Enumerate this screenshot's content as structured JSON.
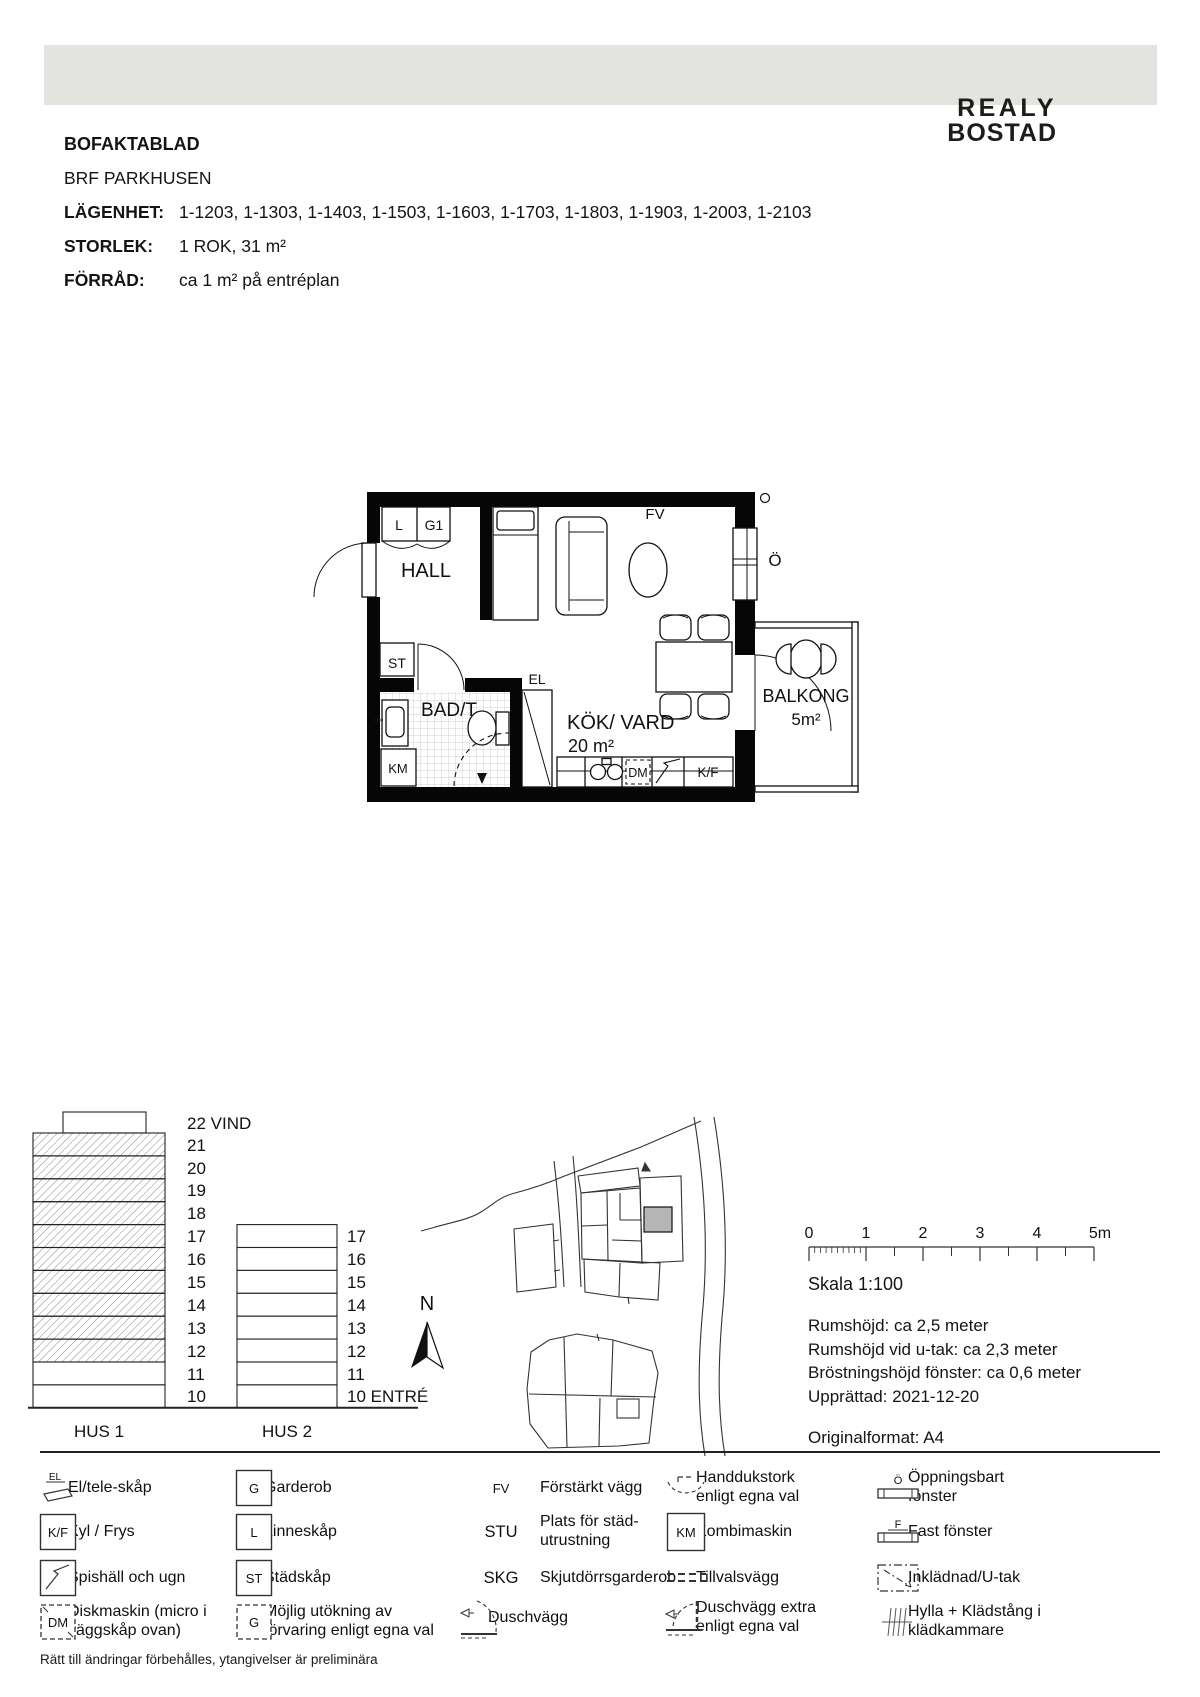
{
  "header": {
    "logo_line1": "REALY",
    "logo_line2": "BOSTAD"
  },
  "info": {
    "title": "BOFAKTABLAD",
    "subtitle": "BRF PARKHUSEN",
    "rows": [
      {
        "label": "LÄGENHET:",
        "value": "1-1203, 1-1303, 1-1403, 1-1503, 1-1603, 1-1703, 1-1803, 1-1903, 1-2003, 1-2103"
      },
      {
        "label": "STORLEK:",
        "value": "1 ROK, 31 m²"
      },
      {
        "label": "FÖRRÅD:",
        "value": "ca 1 m² på entréplan"
      }
    ]
  },
  "floorplan": {
    "hall": "HALL",
    "closet_l": "L",
    "closet_g1": "G1",
    "st": "ST",
    "el": "EL",
    "bad": "BAD/T",
    "km": "KM",
    "dm": "DM",
    "kf": "K/F",
    "fv": "FV",
    "window_o": "Ö",
    "kok_line1": "KÖK/ VARD",
    "kok_line2": "20 m²",
    "balcony_line1": "BALKONG",
    "balcony_line2": "5m²"
  },
  "elevations": {
    "hus1": {
      "name": "HUS 1",
      "floor_labels": [
        "22 VIND",
        "21",
        "20",
        "19",
        "18",
        "17",
        "16",
        "15",
        "14",
        "13",
        "12",
        "11",
        "10"
      ]
    },
    "hus2": {
      "name": "HUS 2",
      "floor_labels": [
        "17",
        "16",
        "15",
        "14",
        "13",
        "12",
        "11",
        "10 ENTRÉ"
      ]
    },
    "north": "N"
  },
  "scalebar": {
    "tick_labels": [
      "0",
      "1",
      "2",
      "3",
      "4",
      "5m"
    ],
    "caption": "Skala 1:100"
  },
  "details": {
    "lines": [
      "Rumshöjd: ca 2,5 meter",
      "Rumshöjd vid u-tak: ca 2,3 meter",
      "Bröstningshöjd fönster: ca 0,6 meter",
      "Upprättad: 2021-12-20"
    ],
    "format_line": "Originalformat: A4"
  },
  "legend": {
    "items": [
      {
        "symbol": "EL",
        "label": "El/tele-skåp"
      },
      {
        "symbol": "K/F",
        "label": "Kyl / Frys"
      },
      {
        "label": "Spishäll och ugn"
      },
      {
        "symbol": "DM",
        "label": "Diskmaskin (micro i väggskåp ovan)"
      },
      {
        "symbol": "G",
        "label": "Garderob"
      },
      {
        "symbol": "L",
        "label": "Linneskåp"
      },
      {
        "symbol": "ST",
        "label": "Städskåp"
      },
      {
        "symbol": "G",
        "label": "Möjlig utökning av förvaring enligt egna val"
      },
      {
        "symbol": "FV",
        "label": "Förstärkt vägg"
      },
      {
        "symbol": "STU",
        "label": "Plats för städ-utrustning"
      },
      {
        "symbol": "SKG",
        "label": "Skjutdörrsgarderob"
      },
      {
        "label": "Duschvägg"
      },
      {
        "label": "Handdukstork enligt egna val"
      },
      {
        "symbol": "KM",
        "label": "Kombimaskin"
      },
      {
        "label": "Tillvalsvägg"
      },
      {
        "label": "Duschvägg extra enligt egna val"
      },
      {
        "symbol": "Ö",
        "label": "Öppningsbart fönster"
      },
      {
        "symbol": "F",
        "label": "Fast fönster"
      },
      {
        "label": "Inklädnad/U-tak"
      },
      {
        "label": "Hylla + Klädstång i klädkammare"
      }
    ],
    "footnote": "Rätt till ändringar förbehålles, ytangivelser är preliminära"
  },
  "colors": {
    "header_band": "#e3e4df",
    "highlight_unit": "#b5b5b5"
  }
}
